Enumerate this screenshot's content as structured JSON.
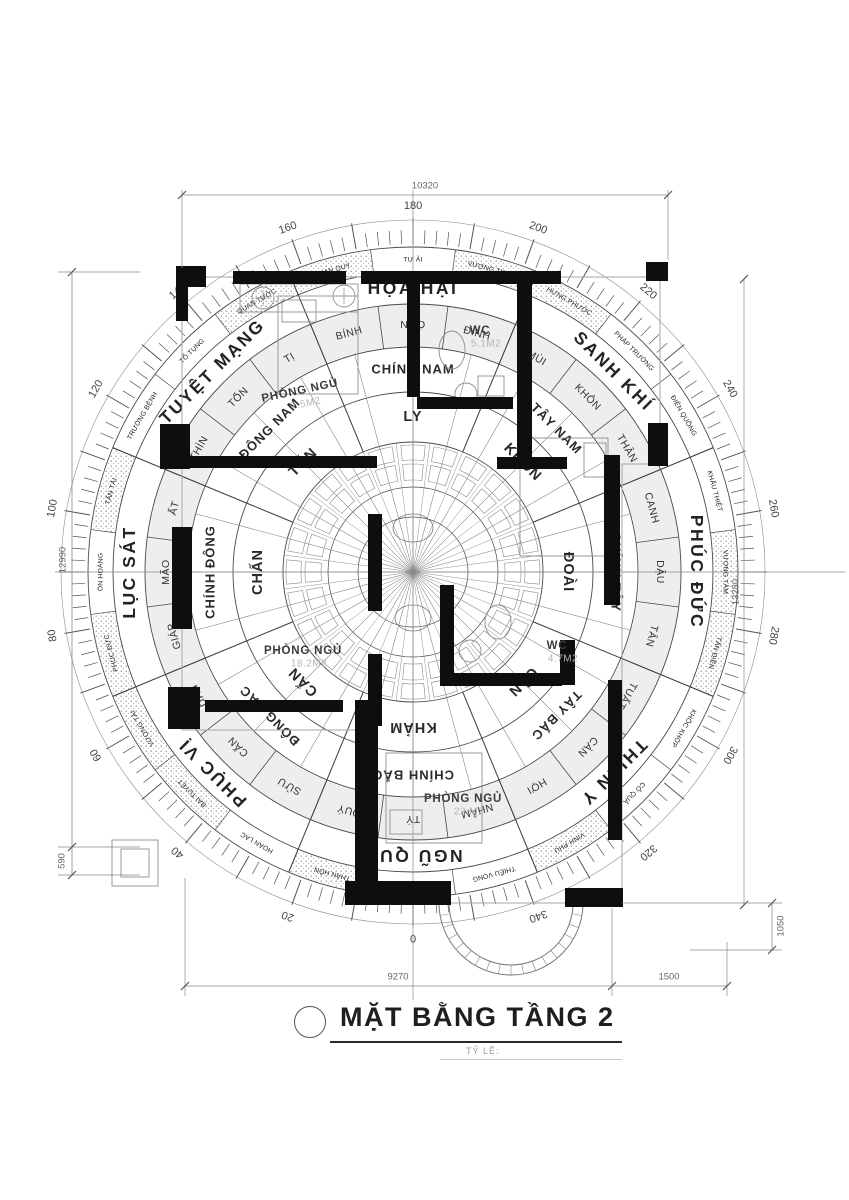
{
  "title": {
    "text": "MẶT BẰNG TẦNG 2",
    "scale_label": "TỶ LỆ:"
  },
  "compass": {
    "degree_labels": [
      0,
      20,
      40,
      60,
      80,
      100,
      120,
      140,
      160,
      180,
      200,
      220,
      240,
      260,
      280,
      300,
      320,
      340
    ],
    "sectors": [
      {
        "a": 180,
        "t": "HỌA HẠI"
      },
      {
        "a": 225,
        "t": "SANH KHÍ"
      },
      {
        "a": 270,
        "t": "PHÚC ĐỨC"
      },
      {
        "a": 315,
        "t": "THIÊN Y"
      },
      {
        "a": 0,
        "t": "NGŨ QUỶ"
      },
      {
        "a": 45,
        "t": "PHỤC VỊ"
      },
      {
        "a": 90,
        "t": "LỤC SÁT"
      },
      {
        "a": 135,
        "t": "TUYỆT MẠNG"
      }
    ],
    "directions": [
      {
        "a": 180,
        "t": "CHÍNH NAM"
      },
      {
        "a": 225,
        "t": "TÂY NAM"
      },
      {
        "a": 270,
        "t": "CHÍNH TÂY"
      },
      {
        "a": 315,
        "t": "TÂY BẮC"
      },
      {
        "a": 0,
        "t": "CHÍNH BẮC"
      },
      {
        "a": 45,
        "t": "ĐÔNG BẮC"
      },
      {
        "a": 90,
        "t": "CHÍNH ĐÔNG"
      },
      {
        "a": 135,
        "t": "ĐÔNG NAM"
      }
    ],
    "trigrams": [
      {
        "a": 180,
        "t": "LY"
      },
      {
        "a": 225,
        "t": "KHÔN"
      },
      {
        "a": 270,
        "t": "ĐOÀI"
      },
      {
        "a": 315,
        "t": "CÀN"
      },
      {
        "a": 0,
        "t": "KHẢM"
      },
      {
        "a": 45,
        "t": "CẤN"
      },
      {
        "a": 90,
        "t": "CHẤN"
      },
      {
        "a": 135,
        "t": "TỐN"
      }
    ],
    "mountains": [
      {
        "a": 180,
        "t": "NGỌ"
      },
      {
        "a": 195,
        "t": "ĐINH"
      },
      {
        "a": 210,
        "t": "MÙI"
      },
      {
        "a": 225,
        "t": "KHÔN"
      },
      {
        "a": 240,
        "t": "THÂN"
      },
      {
        "a": 255,
        "t": "CANH"
      },
      {
        "a": 270,
        "t": "DẬU"
      },
      {
        "a": 285,
        "t": "TÂN"
      },
      {
        "a": 300,
        "t": "TUẤT"
      },
      {
        "a": 315,
        "t": "CÀN"
      },
      {
        "a": 330,
        "t": "HỢI"
      },
      {
        "a": 345,
        "t": "NHÂM"
      },
      {
        "a": 0,
        "t": "TÝ"
      },
      {
        "a": 15,
        "t": "QUÝ"
      },
      {
        "a": 30,
        "t": "SỬU"
      },
      {
        "a": 45,
        "t": "CẤN"
      },
      {
        "a": 60,
        "t": "DẦN"
      },
      {
        "a": 75,
        "t": "GIÁP"
      },
      {
        "a": 90,
        "t": "MÃO"
      },
      {
        "a": 105,
        "t": "ẤT"
      },
      {
        "a": 120,
        "t": "THÌN"
      },
      {
        "a": 135,
        "t": "TỐN"
      },
      {
        "a": 150,
        "t": "TỊ"
      },
      {
        "a": 165,
        "t": "BÍNH"
      }
    ],
    "stars": [
      {
        "a": 180,
        "t": "TỰ ẢI",
        "s": false
      },
      {
        "a": 195,
        "t": "VƯỢNG TRANG",
        "s": true
      },
      {
        "a": 210,
        "t": "HƯNG PHƯỚC",
        "s": true
      },
      {
        "a": 225,
        "t": "PHÁP TRƯỜNG",
        "s": false
      },
      {
        "a": 240,
        "t": "ĐIÊN QUỒNG",
        "s": false
      },
      {
        "a": 255,
        "t": "KHẨU THIỆT",
        "s": false
      },
      {
        "a": 270,
        "t": "VƯỢNG TÂM",
        "s": true
      },
      {
        "a": 285,
        "t": "TẤN ĐIỀN",
        "s": true
      },
      {
        "a": 300,
        "t": "KHỐC KHỚP",
        "s": false
      },
      {
        "a": 315,
        "t": "CÔ QUẢ",
        "s": false
      },
      {
        "a": 330,
        "t": "VINH PHÚ",
        "s": true
      },
      {
        "a": 345,
        "t": "THIẾU VONG",
        "s": false
      },
      {
        "a": 0,
        "t": "DƯƠNG",
        "s": false
      },
      {
        "a": 15,
        "t": "THÂN HÔN",
        "s": true
      },
      {
        "a": 30,
        "t": "HOAN LẠC",
        "s": false
      },
      {
        "a": 45,
        "t": "BẠI TUYỆT",
        "s": true
      },
      {
        "a": 60,
        "t": "VƯỢNG TÀI",
        "s": true
      },
      {
        "a": 75,
        "t": "PHÚC ĐỨC",
        "s": true
      },
      {
        "a": 90,
        "t": "ÔN HOÀNG",
        "s": false
      },
      {
        "a": 105,
        "t": "TẤN TÀI",
        "s": true
      },
      {
        "a": 120,
        "t": "TRƯỜNG BỆNH",
        "s": false
      },
      {
        "a": 135,
        "t": "TỐ TỤNG",
        "s": false
      },
      {
        "a": 150,
        "t": "QUAN TƯỚC",
        "s": true
      },
      {
        "a": 165,
        "t": "QUAN QUÝ",
        "s": true
      }
    ]
  },
  "rooms": [
    {
      "label": "PHÒNG NGỦ",
      "area": "7.5M2",
      "x": 300,
      "y": 391,
      "rot": -12
    },
    {
      "label": "WC",
      "area": "5.1M2",
      "x": 480,
      "y": 331,
      "rot": 0
    },
    {
      "label": "PHÒNG NGỦ",
      "area": "18.2M2",
      "x": 303,
      "y": 651,
      "rot": 0
    },
    {
      "label": "WC",
      "area": "4.7M2",
      "x": 557,
      "y": 646,
      "rot": 0
    },
    {
      "label": "PHÒNG NGỦ",
      "area": "22.M2",
      "x": 463,
      "y": 799,
      "rot": 0
    }
  ],
  "dimensions": {
    "top": "10320",
    "bottom_left": "9270",
    "bottom_right": "1500",
    "left_total": "12990",
    "left_small": "590",
    "right_total": "13280",
    "right_small": "1050"
  }
}
